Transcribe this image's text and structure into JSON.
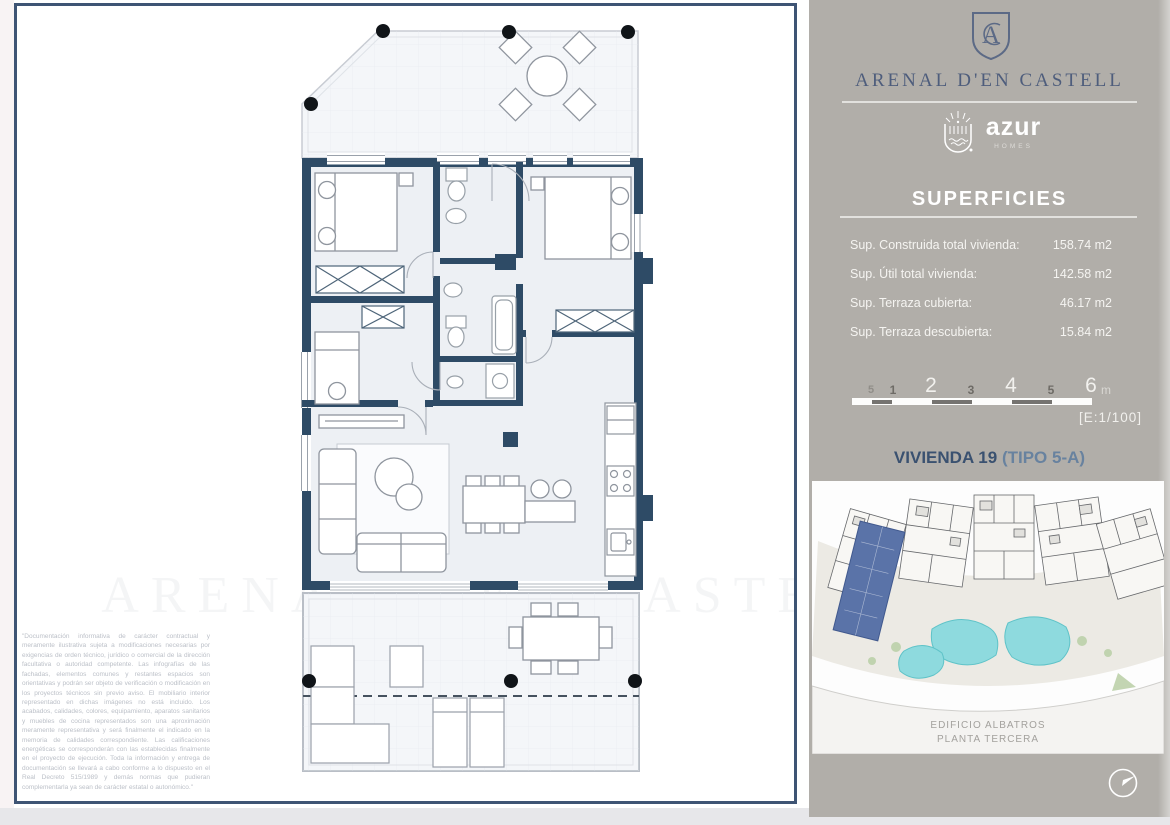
{
  "plan": {
    "watermark": "ARENAL D'EN CASTELL",
    "disclaimer": "\"Documentación informativa de carácter contractual y meramente ilustrativa sujeta a modificaciones necesarias por exigencias de orden técnico, jurídico o comercial de la dirección facultativa o autoridad competente. Las infografías de las fachadas, elementos comunes y restantes espacios son orientativas y podrán ser objeto de verificación o modificación en los proyectos técnicos sin previo aviso. El mobiliario interior representado en dichas imágenes no está incluido. Los acabados, calidades, colores, equipamiento, aparatos sanitarios y muebles de cocina representados son una aproximación meramente representativa y será finalmente el indicado en la memoria de calidades correspondiente. Las calificaciones energéticas se corresponderán con las establecidas finalmente en el proyecto de ejecución. Toda la información y entrega de documentación se llevará a cabo conforme a lo dispuesto en el Real Decreto 515/1989 y demás normas que pudieran complementarla ya sean de carácter estatal o autonómico.\""
  },
  "sidebar": {
    "brand": {
      "name": "ARENAL D'EN CASTELL",
      "monogram": "A"
    },
    "logo": {
      "name": "azur",
      "tagline": "HOMES"
    },
    "superficies": {
      "title": "SUPERFICIES",
      "rows": [
        {
          "label": "Sup. Construida total vivienda:",
          "value": "158.74 m2"
        },
        {
          "label": "Sup. Útil total vivienda:",
          "value": "142.58 m2"
        },
        {
          "label": "Sup. Terraza cubierta:",
          "value": "46.17 m2"
        },
        {
          "label": "Sup. Terraza descubierta:",
          "value": "15.84 m2"
        }
      ]
    },
    "scalebar": {
      "ticks": [
        "5",
        "1",
        "2",
        "3",
        "4",
        "5",
        "6"
      ],
      "unit": "m",
      "note": "[E:1/100]"
    },
    "unit": {
      "name": "VIVIENDA 19",
      "type": "(TIPO 5-A)"
    },
    "siteplan": {
      "line1": "EDIFICIO ALBATROS",
      "line2": "PLANTA TERCERA"
    }
  },
  "colors": {
    "sidebar_bg": "#b1aea9",
    "frame_border": "#3e5474",
    "wall_navy": "#2e4b66",
    "unit_name_navy": "#3a5170",
    "unit_type_blue": "#68829f",
    "highlight_unit_blue": "#5a73a8",
    "pool_teal": "#8edade"
  }
}
